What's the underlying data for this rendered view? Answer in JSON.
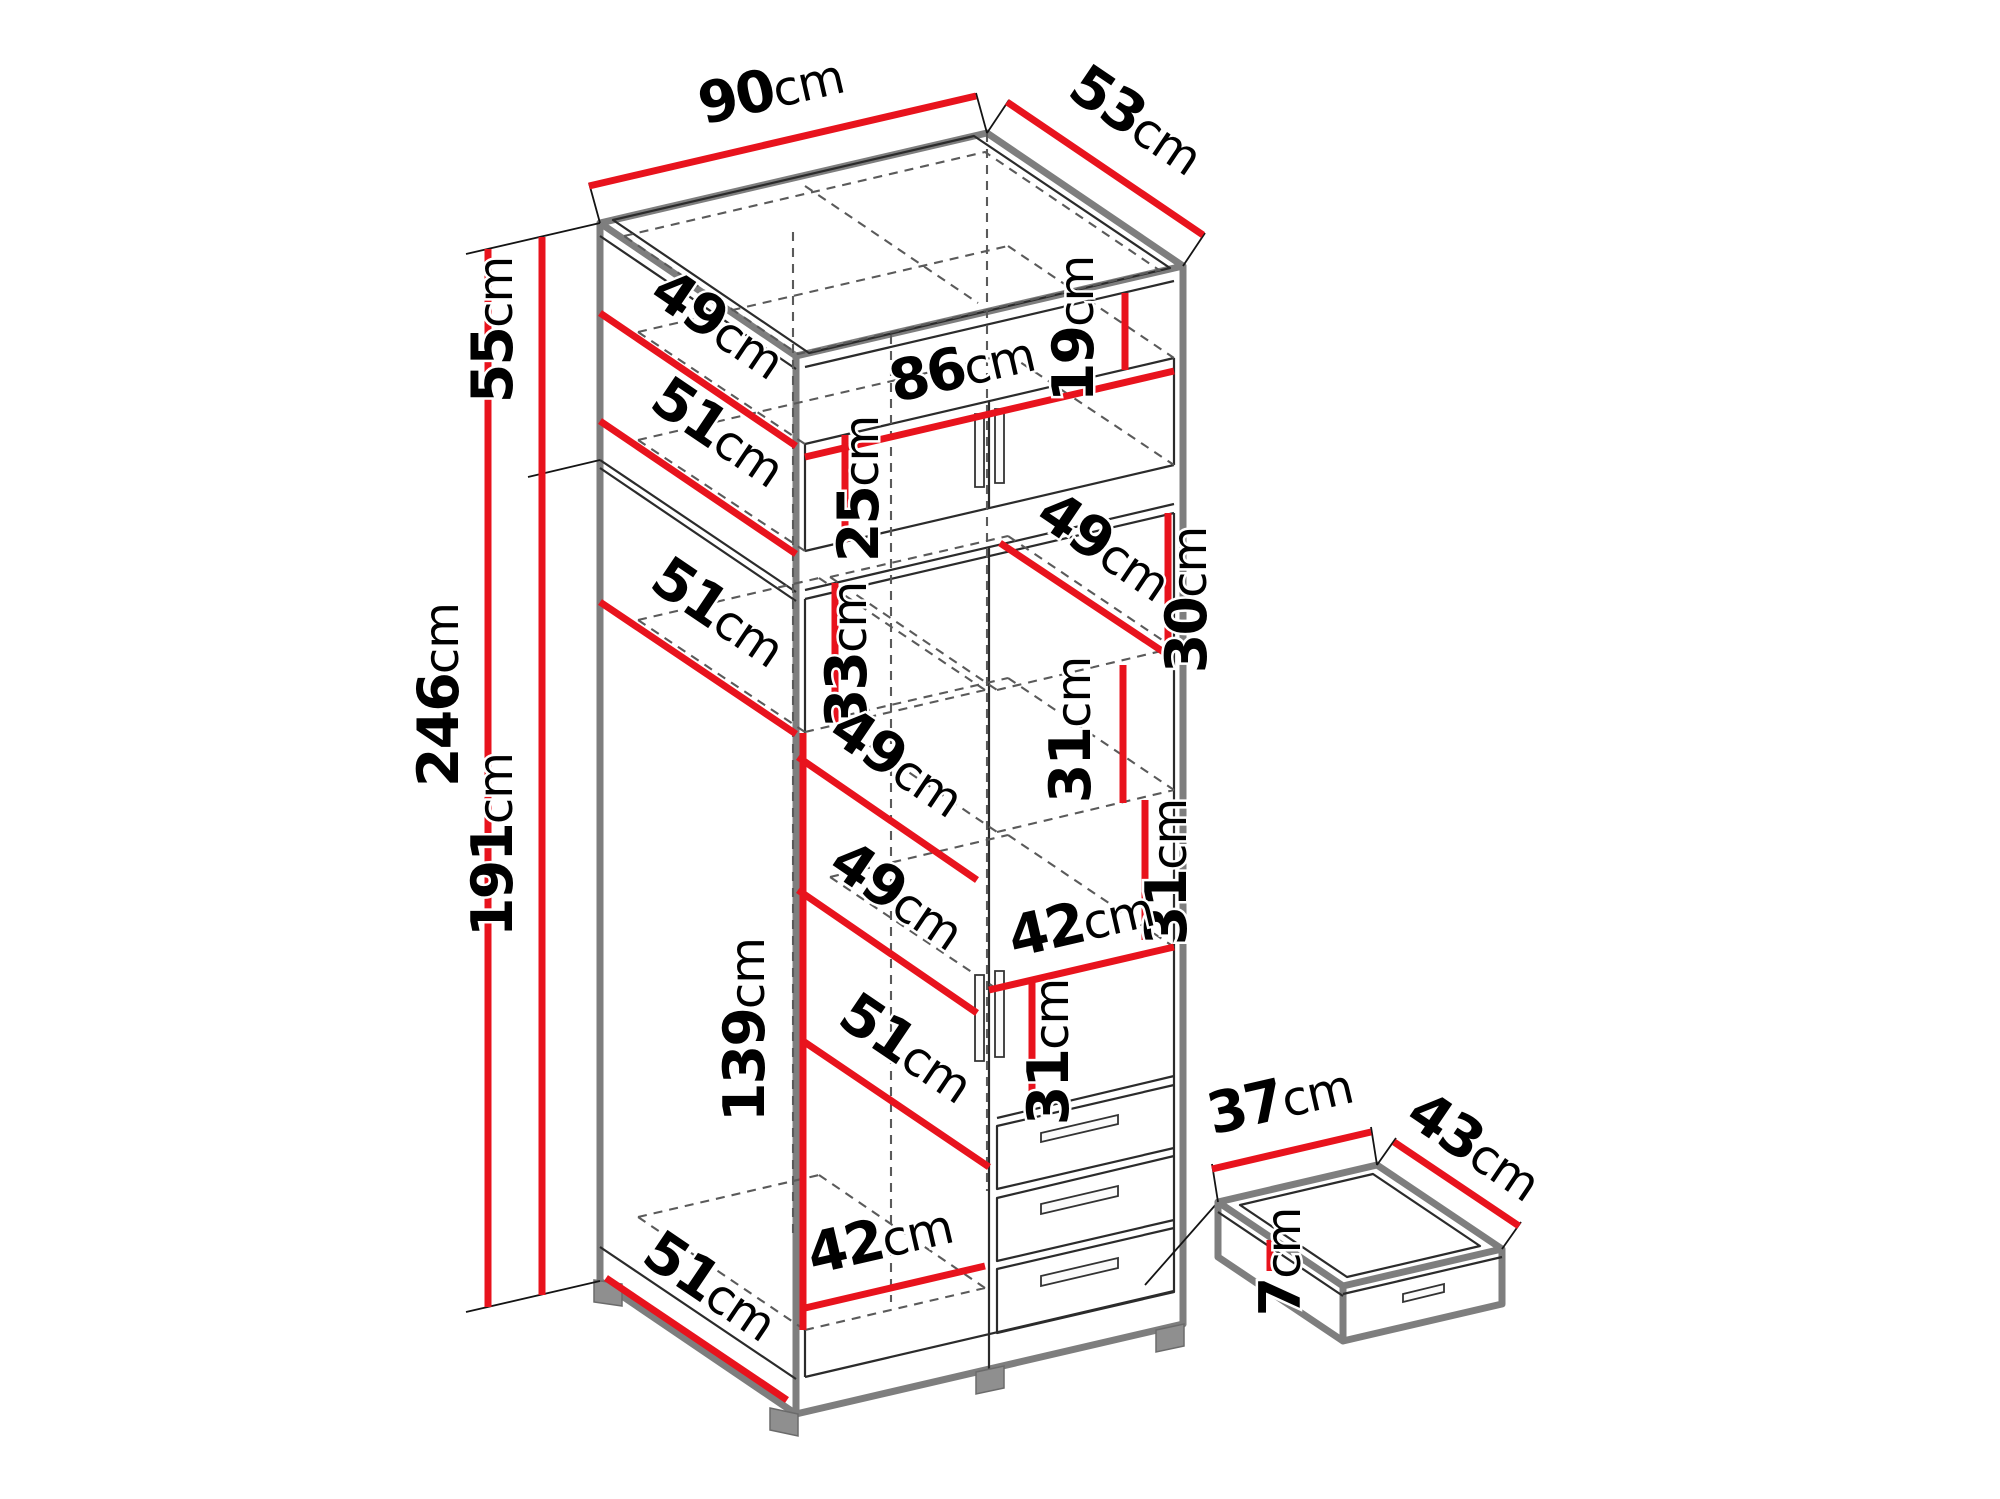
{
  "page": {
    "title": "Wardrobe technical dimension drawing",
    "background": "#ffffff"
  },
  "style": {
    "dimension_color": "#e8131d",
    "edge_color": "#7e7e7e",
    "detail_color": "#2b2b2b",
    "text_color": "#000000"
  },
  "wardrobe": {
    "overall_width_cm": 90,
    "overall_depth_cm": 53,
    "overall_height_cm": 246,
    "top_section_height_cm": 55,
    "lower_section_height_cm": 191,
    "drawer_count": 3
  },
  "dims": {
    "width_top": {
      "num": "90",
      "unit": "cm"
    },
    "depth_top": {
      "num": "53",
      "unit": "cm"
    },
    "height_top_section": {
      "num": "55",
      "unit": "cm"
    },
    "height_total": {
      "num": "246",
      "unit": "cm"
    },
    "height_lower_section": {
      "num": "191",
      "unit": "cm"
    },
    "niche_depth": {
      "num": "49",
      "unit": "cm"
    },
    "top_shelf_depth": {
      "num": "51",
      "unit": "cm"
    },
    "top_doors_width": {
      "num": "86",
      "unit": "cm"
    },
    "niche_height": {
      "num": "19",
      "unit": "cm"
    },
    "top_doors_height": {
      "num": "25",
      "unit": "cm"
    },
    "mid_shelf_depth": {
      "num": "51",
      "unit": "cm"
    },
    "left_compartment_height": {
      "num": "33",
      "unit": "cm"
    },
    "right_shelf_depth": {
      "num": "49",
      "unit": "cm"
    },
    "right_comp1_height": {
      "num": "30",
      "unit": "cm"
    },
    "right_comp2_height": {
      "num": "31",
      "unit": "cm"
    },
    "center_shelf1_depth": {
      "num": "49",
      "unit": "cm"
    },
    "right_comp3_height": {
      "num": "31",
      "unit": "cm"
    },
    "center_shelf2_depth": {
      "num": "49",
      "unit": "cm"
    },
    "right_column_width": {
      "num": "42",
      "unit": "cm"
    },
    "right_comp4_height": {
      "num": "31",
      "unit": "cm"
    },
    "center_shelf3_depth": {
      "num": "51",
      "unit": "cm"
    },
    "hanging_space_height": {
      "num": "139",
      "unit": "cm"
    },
    "left_column_width": {
      "num": "42",
      "unit": "cm"
    },
    "bottom_depth": {
      "num": "51",
      "unit": "cm"
    },
    "drawer_width": {
      "num": "37",
      "unit": "cm"
    },
    "drawer_depth": {
      "num": "43",
      "unit": "cm"
    },
    "drawer_height": {
      "num": "7",
      "unit": "cm"
    }
  }
}
